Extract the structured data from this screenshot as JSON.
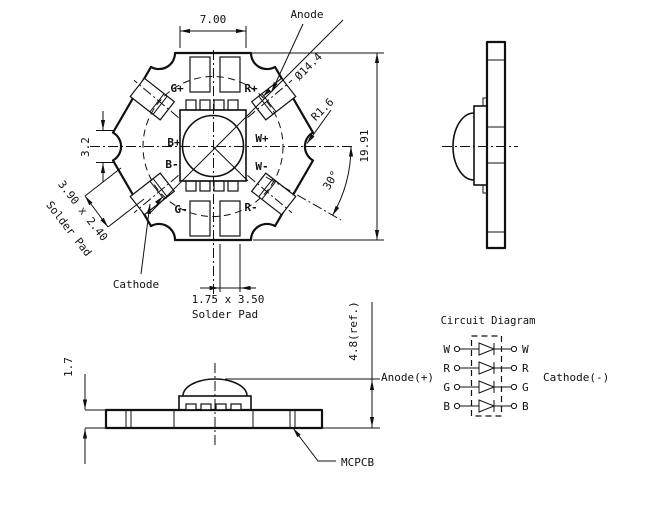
{
  "star": {
    "dims": {
      "width": "7.00",
      "diameter": "Ø14.4",
      "radius": "R1.6",
      "height": "19.91",
      "notch": "3.2",
      "angle": "30°"
    },
    "diag_pad": {
      "line1": "3.90 x 2.40",
      "line2": "Solder Pad"
    },
    "bottom_pad": {
      "line1": "1.75 x 3.50",
      "line2": "Solder Pad"
    },
    "anode": "Anode",
    "cathode": "Cathode",
    "pad_labels": [
      "G+",
      "R+",
      "B+",
      "W+",
      "B-",
      "W-",
      "G-",
      "R-"
    ]
  },
  "front": {
    "thickness": "1.7",
    "height": "4.8(ref.)",
    "board": "MCPCB"
  },
  "circuit": {
    "title": "Circuit Diagram",
    "anode": "Anode(+)",
    "cathode": "Cathode(-)",
    "channels": [
      "W",
      "R",
      "G",
      "B"
    ]
  }
}
